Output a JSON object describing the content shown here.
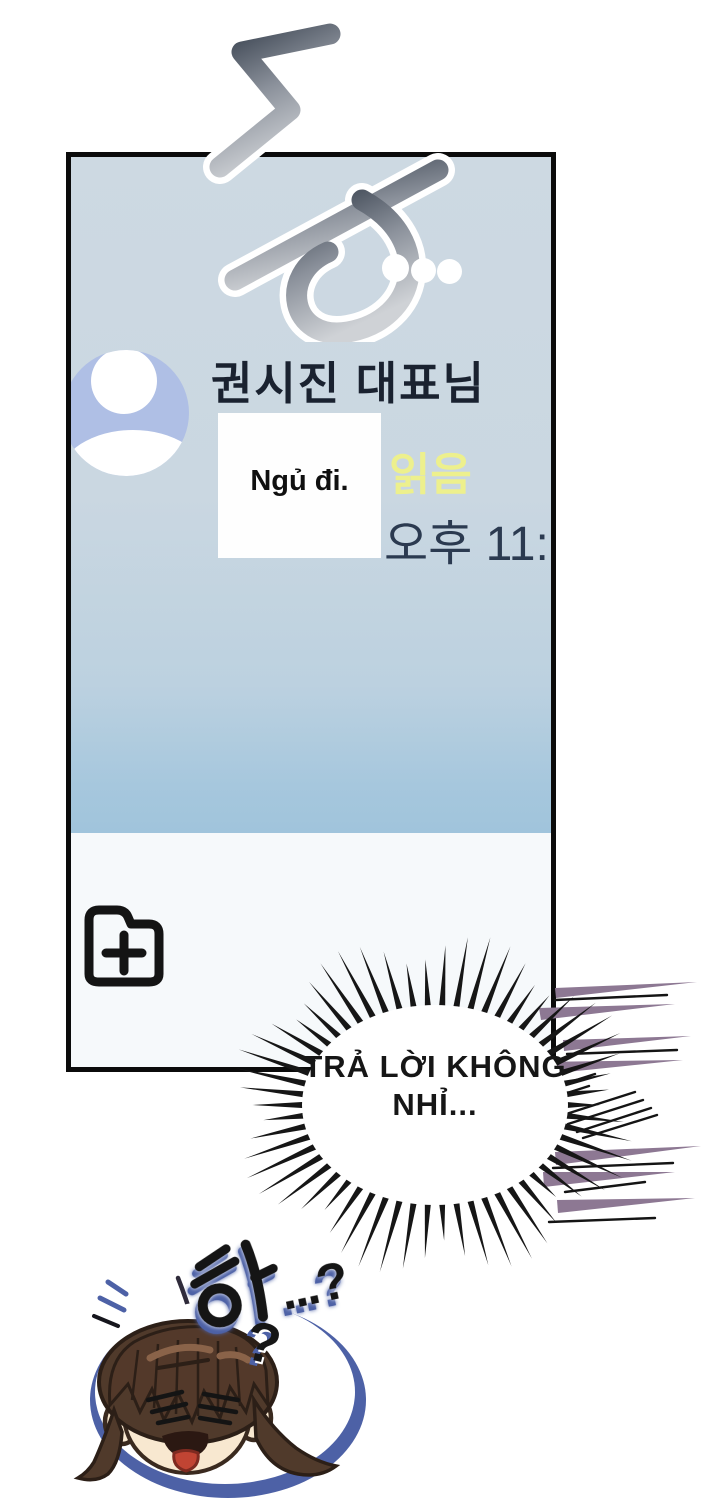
{
  "sfx_top": {
    "text": "둥",
    "trail": "..."
  },
  "phone_chat": {
    "contact_name": "권시진 대표님",
    "message_bubble": {
      "text": "Ngủ đi."
    },
    "read_receipt": "읽음",
    "timestamp": "오후 11:"
  },
  "burst_speech": {
    "line1": "TRẢ LỜI KHÔNG",
    "line2": "NHỈ..."
  },
  "sfx_bottom": {
    "hangul": "하",
    "tail": "...?",
    "floating_question": "?"
  },
  "icons": {
    "avatar": "person-silhouette-icon",
    "attachment": "add-folder-icon"
  },
  "colors": {
    "panel_border": "#0b0b0b",
    "chat_bg_top": "#cdd9e2",
    "chat_bg_bottom": "#a0c4dc",
    "input_area_bg": "#f6f9fb",
    "avatar_fill": "#afbfe5",
    "contact_text": "#1a2230",
    "read_receipt_text": "#edf08d",
    "timestamp_text": "#2b3a50",
    "speedline_purple": "#8d7893",
    "outline_blue": "#4d61a6",
    "hair_brown": "#503a2b",
    "skin": "#f8e8d0",
    "tongue_red": "#c14433"
  }
}
